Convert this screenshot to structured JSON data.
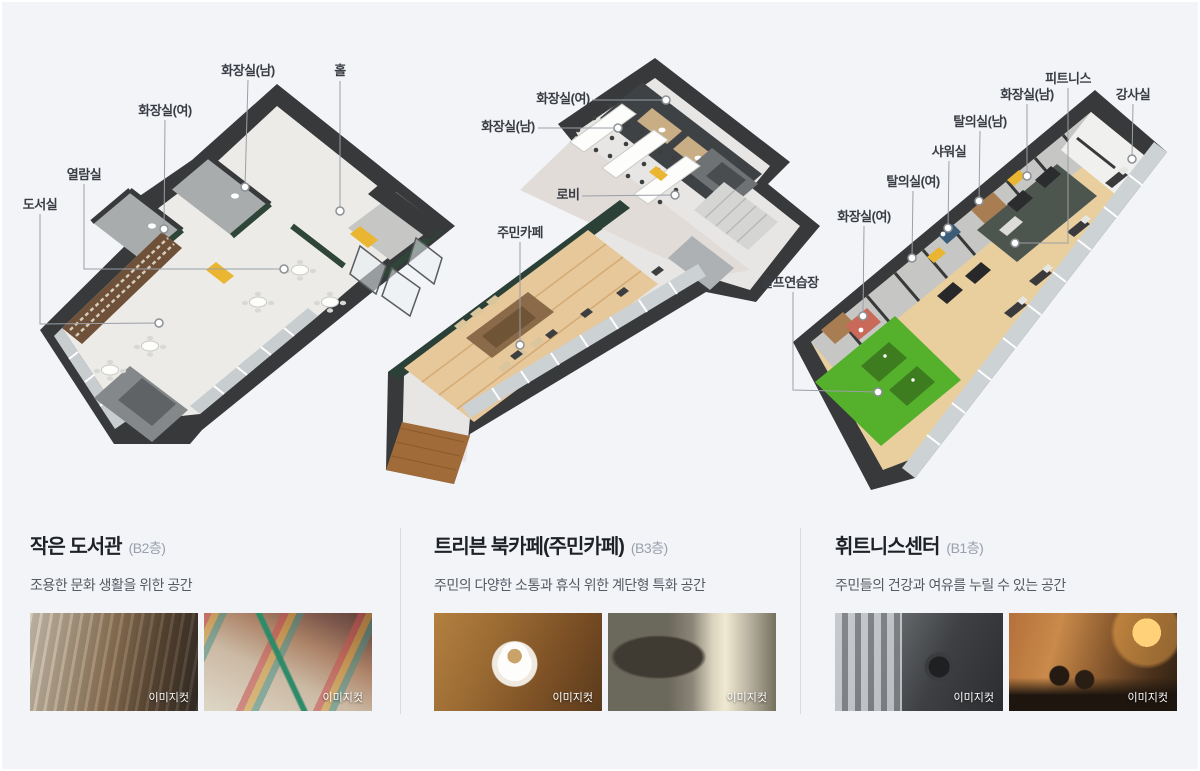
{
  "palette": {
    "background": "#f2f4f8",
    "wall_dark": "#37393b",
    "green_wall": "#2e4538",
    "golf_green": "#55b02c",
    "wood_floor": "#e6c89b",
    "accent_yellow": "#eab632"
  },
  "plans": {
    "library": {
      "labels": [
        "도서실",
        "열람실",
        "화장실(여)",
        "화장실(남)",
        "홀"
      ]
    },
    "cafe": {
      "labels": [
        "화장실(여)",
        "화장실(남)",
        "로비",
        "주민카페"
      ]
    },
    "fitness": {
      "labels": [
        "화장실(여)",
        "탈의실(여)",
        "샤워실",
        "탈의실(남)",
        "화장실(남)",
        "피트니스",
        "강사실",
        "골프연습장"
      ]
    }
  },
  "sections": [
    {
      "title": "작은 도서관",
      "floor": "(B2층)",
      "desc": "조용한 문화 생활을 위한 공간",
      "photos": [
        {
          "badge": "이미지컷"
        },
        {
          "badge": "이미지컷"
        }
      ]
    },
    {
      "title": "트리븐 북카페(주민카페)",
      "floor": "(B3층)",
      "desc": "주민의 다양한 소통과 휴식 위한 계단형 특화 공간",
      "photos": [
        {
          "badge": "이미지컷"
        },
        {
          "badge": "이미지컷"
        }
      ]
    },
    {
      "title": "휘트니스센터",
      "floor": "(B1층)",
      "desc": "주민들의 건강과 여유를 누릴 수 있는 공간",
      "photos": [
        {
          "badge": "이미지컷"
        },
        {
          "badge": "이미지컷"
        }
      ]
    }
  ]
}
